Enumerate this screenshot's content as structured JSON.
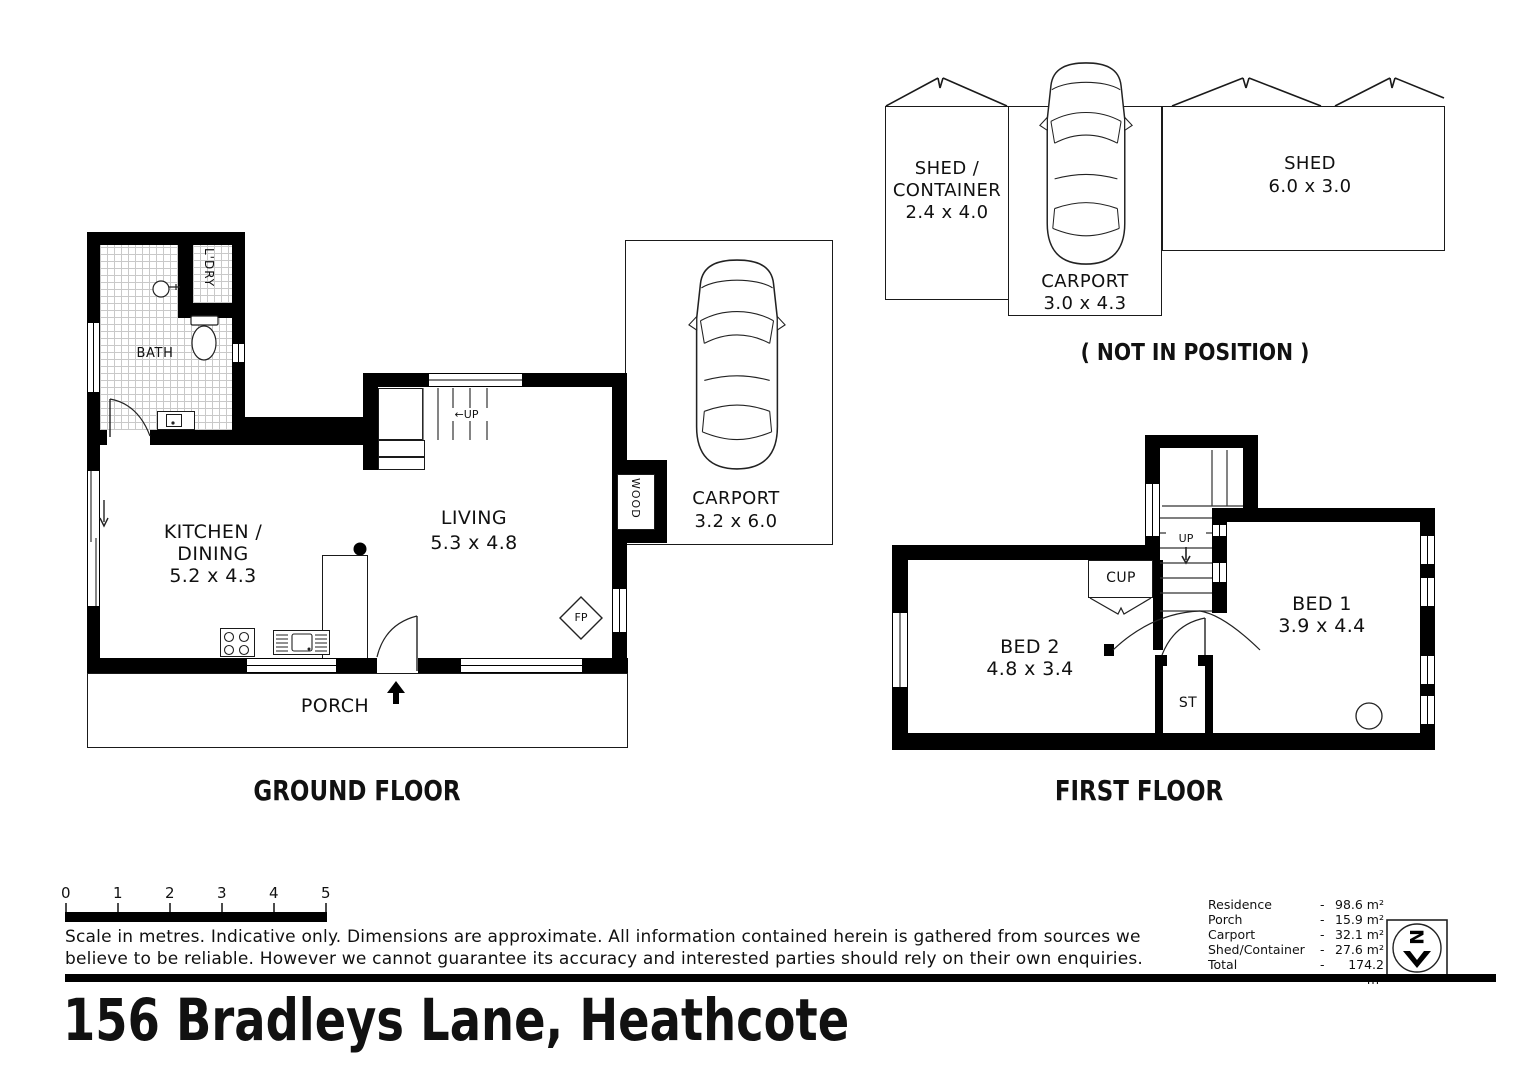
{
  "address": "156 Bradleys Lane, Heathcote",
  "ground_floor": {
    "label": "GROUND FLOOR",
    "bath": "BATH",
    "laundry": "L'DRY",
    "kitchen_line1": "KITCHEN /",
    "kitchen_line2": "DINING",
    "kitchen_dims": "5.2 x 4.3",
    "living": "LIVING",
    "living_dims": "5.3 x 4.8",
    "carport": "CARPORT",
    "carport_dims": "3.2 x 6.0",
    "porch": "PORCH",
    "wood_heater": "WOOD",
    "fireplace": "FP",
    "stairs_up": "←UP"
  },
  "first_floor": {
    "label": "FIRST FLOOR",
    "bed1": "BED 1",
    "bed1_dims": "3.9 x 4.4",
    "bed2": "BED 2",
    "bed2_dims": "4.8 x 3.4",
    "cupboard": "CUP",
    "storage": "ST",
    "stairs_up": "UP"
  },
  "outbuildings": {
    "note": "( NOT IN POSITION )",
    "shed_container_line1": "SHED /",
    "shed_container_line2": "CONTAINER",
    "shed_container_dims": "2.4 x 4.0",
    "carport": "CARPORT",
    "carport_dims": "3.0 x 4.3",
    "shed": "SHED",
    "shed_dims": "6.0 x 3.0"
  },
  "scale_bar": {
    "ticks": [
      "0",
      "1",
      "2",
      "3",
      "4",
      "5"
    ]
  },
  "disclaimer_line1": "Scale in metres. Indicative only. Dimensions are approximate. All information contained herein is gathered from sources we",
  "disclaimer_line2": "believe to be reliable. However we cannot guarantee  its accuracy and interested parties should rely on their own enquiries.",
  "areas": {
    "rows": [
      {
        "label": "Residence",
        "sep": "-",
        "value": "98.6 m²"
      },
      {
        "label": "Porch",
        "sep": "-",
        "value": "15.9 m²"
      },
      {
        "label": "Carport",
        "sep": "-",
        "value": "32.1 m²"
      },
      {
        "label": "Shed/Container",
        "sep": "-",
        "value": "27.6 m²"
      },
      {
        "label": "Total",
        "sep": "-",
        "value": "174.2 m²"
      }
    ]
  },
  "compass": {
    "north_letter": "N"
  }
}
